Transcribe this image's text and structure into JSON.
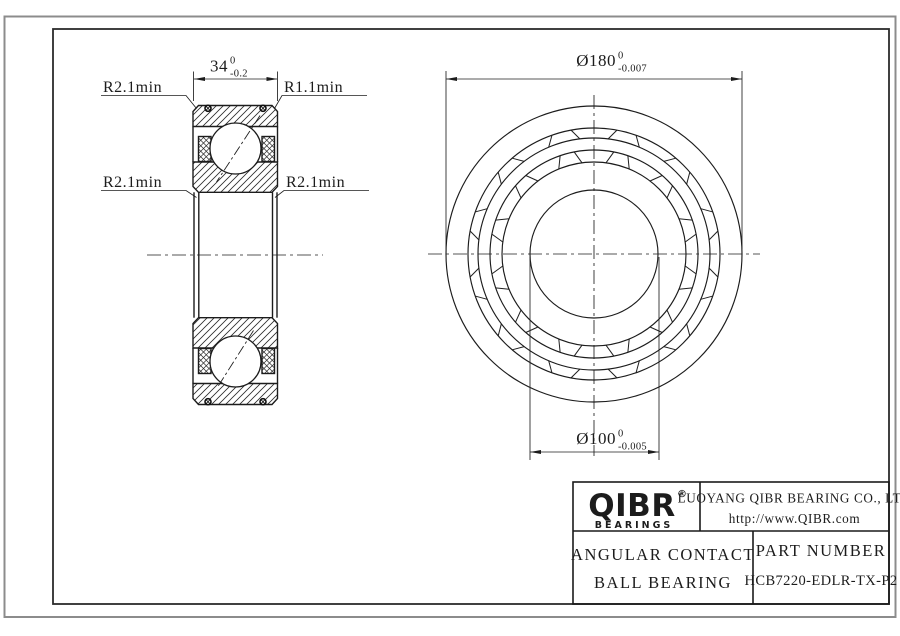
{
  "sheet": {
    "section_view": {
      "width_dim": {
        "value": "34",
        "tol_upper": "0",
        "tol_lower": "-0.2"
      },
      "radius_labels": {
        "top_left": "R2.1min",
        "top_right": "R1.1min",
        "mid_left": "R2.1min",
        "mid_right": "R2.1min"
      }
    },
    "front_view": {
      "outer_diameter_dim": {
        "value": "Ø180",
        "tol_upper": "0",
        "tol_lower": "-0.007"
      },
      "bore_diameter_dim": {
        "value": "Ø100",
        "tol_upper": "0",
        "tol_lower": "-0.005"
      }
    }
  },
  "title_block": {
    "logo": {
      "text": "QIBR",
      "registered": "®",
      "subtext": "BEARINGS"
    },
    "company": "LUOYANG QIBR BEARING CO., LTD",
    "website": "http://www.QIBR.com",
    "product_type_line1": "ANGULAR CONTACT",
    "product_type_line2": "BALL BEARING",
    "part_number_label": "PART NUMBER",
    "part_number": "HCB7220-EDLR-TX-P2"
  }
}
